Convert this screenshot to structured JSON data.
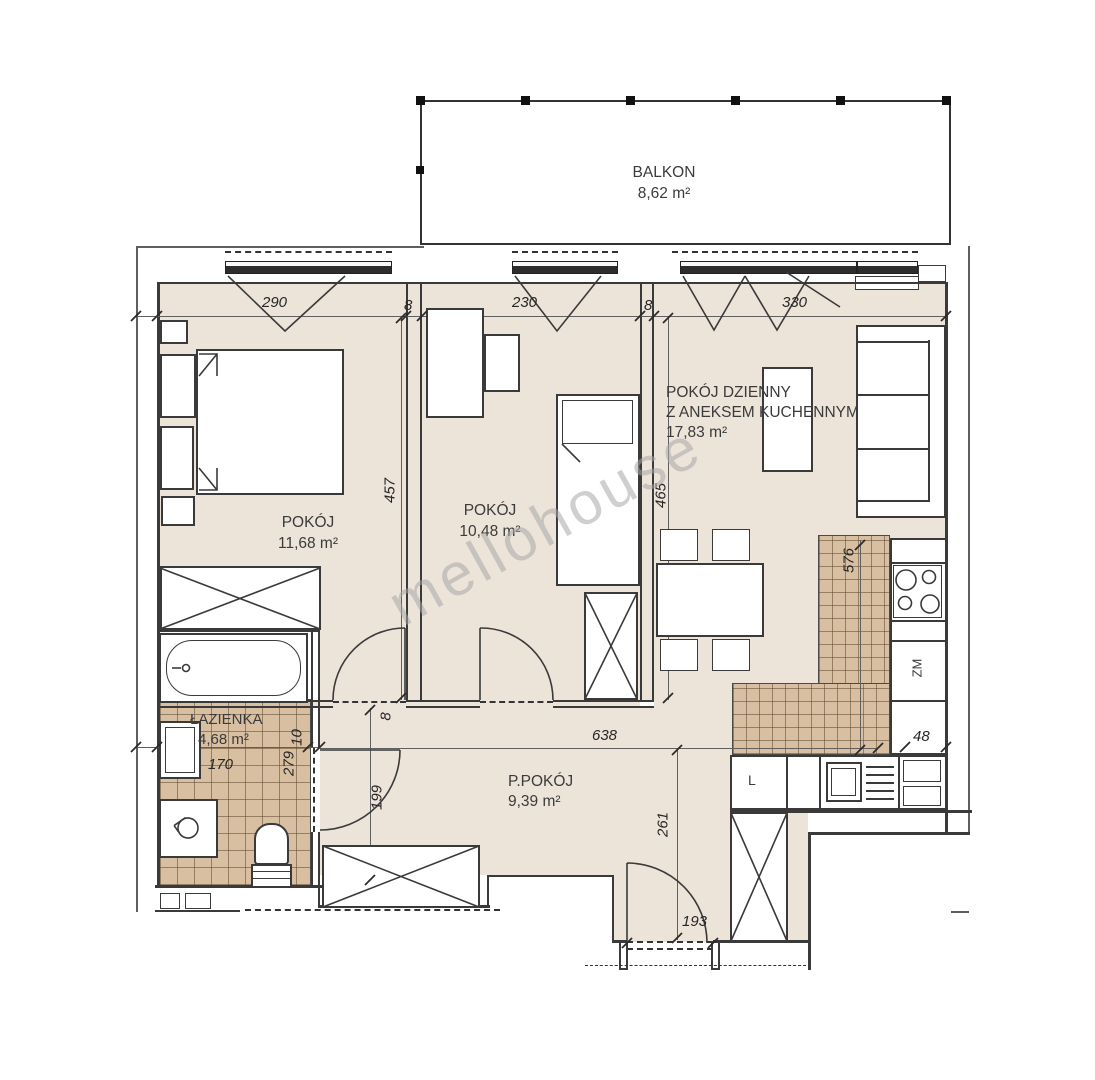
{
  "watermark_text": "mellohouse",
  "balcony": {
    "label": "BALKON",
    "area": "8,62 m²"
  },
  "rooms": {
    "bedroom": {
      "label": "POKÓJ",
      "area": "11,68 m²"
    },
    "small_room": {
      "label": "POKÓJ",
      "area": "10,48 m²"
    },
    "living_room": {
      "label_line1": "POKÓJ DZIENNY",
      "label_line2": "Z ANEKSEM KUCHENNYM",
      "area": "17,83 m²"
    },
    "hallway": {
      "label": "P.POKÓJ",
      "area": "9,39 m²"
    },
    "bathroom": {
      "label": "ŁAZIENKA",
      "area": "4,68 m²"
    }
  },
  "appliances": {
    "dishwasher_label": "ZM",
    "fridge_label": "L"
  },
  "dimensions": {
    "top_bedroom": "290",
    "top_wall_a": "8",
    "top_small_room": "230",
    "top_wall_b": "8",
    "top_living": "330",
    "bedroom_depth": "457",
    "small_room_depth": "465",
    "kitchen_depth": "576",
    "hallway_width": "638",
    "counter_width": "48",
    "bathroom_width": "170",
    "bathroom_wall": "10",
    "bathroom_depth": "279",
    "hallway_door": "199",
    "hall_wall": "8",
    "hallway_depth": "261",
    "entrance_width": "193"
  },
  "colors": {
    "floor": "#ece3d9",
    "tile": "#d8bfa1",
    "line": "#3a3a3a"
  }
}
